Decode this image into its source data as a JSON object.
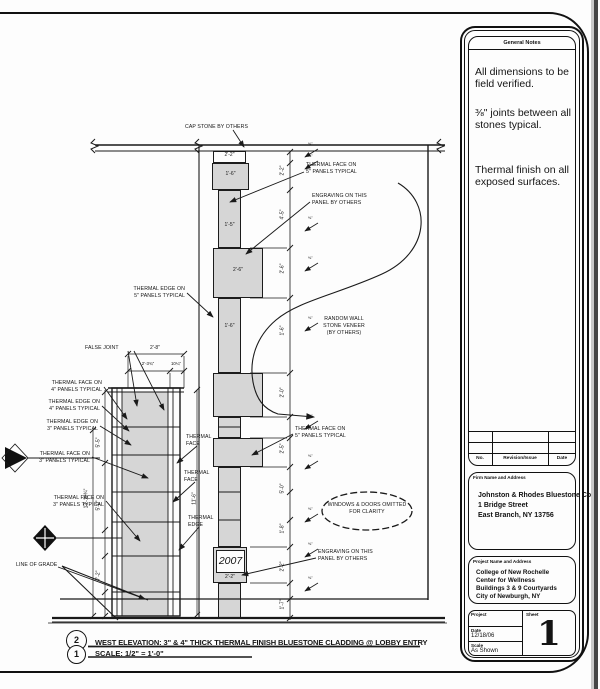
{
  "colors": {
    "ink": "#1a1a1a",
    "stone_fill": "#d6d6d6",
    "paper": "#fdfdfd"
  },
  "sheet": {
    "general_notes": {
      "title": "General Notes",
      "note1": "All dimensions to be field verified.",
      "note2": "⅜\" joints between all stones typical.",
      "note3": "Thermal finish on all exposed surfaces."
    },
    "revision_table": {
      "col_no": "No.",
      "col_revision": "Revision/Issue",
      "col_date": "Date"
    },
    "firm": {
      "label": "Firm Name and Address",
      "line1": "Johnston & Rhodes Bluestone Co.",
      "line2": "1 Bridge Street",
      "line3": "East Branch, NY 13756"
    },
    "project": {
      "label": "Project Name and Address",
      "line1": "College of New Rochelle",
      "line2": "Center for Wellness",
      "line3": "Buildings 3 & 9 Courtyards",
      "line4": "City of Newburgh, NY"
    },
    "stamp": {
      "project_label": "Project",
      "sheet_label": "Sheet",
      "date_label": "Date",
      "date": "12/18/06",
      "scale_label": "Scale",
      "scale": "As Shown",
      "sheet_number": "1"
    }
  },
  "titlebar": {
    "detail_top": "2",
    "detail_bottom": "1",
    "title": "WEST ELEVATION: 3\" & 4\" THICK THERMAL FINISH BLUESTONE CLADDING @ LOBBY ENTRY",
    "scale": "SCALE: 1/2\" = 1'-0\""
  },
  "drawing": {
    "engraving_year": "2007",
    "labels": {
      "cap_stone": "CAP STONE BY OTHERS",
      "thermal_face_5_top": "THERMAL FACE ON\n5\" PANELS TYPICAL",
      "engraving_top": "ENGRAVING ON THIS\nPANEL BY OTHERS",
      "thermal_edge_5": "THERMAL EDGE ON\n5\" PANELS TYPICAL",
      "random_wall": "RANDOM WALL\nSTONE VENEER\n(BY OTHERS)",
      "false_joint": "FALSE JOINT",
      "thermal_face_4": "THERMAL FACE ON\n4\" PANELS TYPICAL",
      "thermal_edge_4": "THERMAL EDGE ON\n4\" PANELS TYPICAL",
      "thermal_edge_3": "THERMAL EDGE ON\n3\" PANELS TYPICAL",
      "thermal_face_3a": "THERMAL FACE ON\n3\" PANELS TYPICAL",
      "thermal_face_3b": "THERMAL FACE ON\n3\" PANELS TYPICAL",
      "thermal_face_mid": "THERMAL\nFACE",
      "thermal_face_mid2": "THERMAL\nFACE",
      "thermal_edge_mid": "THERMAL\nEDGE",
      "thermal_face_5_mid": "THERMAL FACE ON\n5\" PANELS TYPICAL",
      "windows_note": "WINDOWS & DOORS OMITTED\nFOR CLARITY",
      "engraving_bottom": "ENGRAVING ON THIS\nPANEL BY OTHERS",
      "line_of_grade": "LINE OF GRADE"
    },
    "dims": {
      "cap": "2'-2\"",
      "panel_a": "1'-6\"",
      "col1": "1'-5\"",
      "panel_b": "2'-6\"",
      "col2": "1'-6\"",
      "pillar_w": "2'-8\"",
      "pillar_w2": "2'-3¾\"",
      "pillar_w3": "10¼\"",
      "pillar_h": "11'-6\"",
      "left_total": "13'-10¾\"",
      "left_a": "5'-5\"",
      "left_b": "5'-0\"",
      "left_c": "7'-2\"",
      "e2007": "2'-2\"",
      "joint_marker": "⅜\""
    },
    "string_dims": [
      "2'-2\"",
      "4'-5\"",
      "2'-6\"",
      "1'-6\"",
      "2'-0\"",
      "2'-5\"",
      "5'-0\"",
      "1'-8\"",
      "2'-2\"",
      "1'-7\""
    ]
  }
}
